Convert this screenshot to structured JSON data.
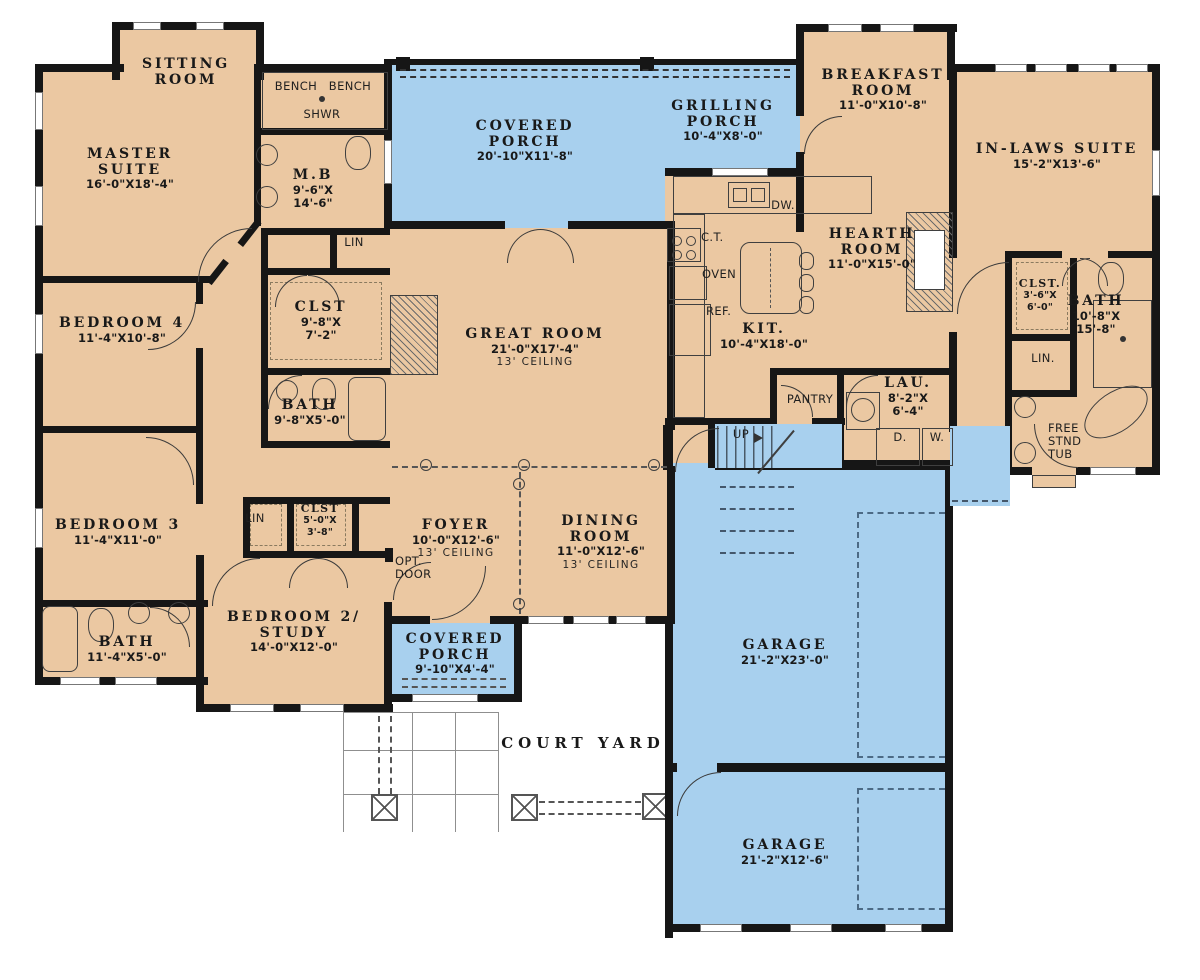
{
  "colors": {
    "floor": "#ebc8a2",
    "porch": "#a8d0ee",
    "wall": "#161616",
    "background": "#ffffff"
  },
  "labels": [
    {
      "id": "sitting-room",
      "x": 186,
      "y": 57,
      "lines": [
        "SITTING",
        "ROOM"
      ]
    },
    {
      "id": "master-suite",
      "x": 130,
      "y": 147,
      "lines": [
        "MASTER",
        "SUITE"
      ],
      "dims": [
        "16'-0\"X18'-4\""
      ]
    },
    {
      "id": "bench-1",
      "x": 296,
      "y": 80,
      "lines": [
        "BENCH"
      ],
      "cls": "sm"
    },
    {
      "id": "bench-2",
      "x": 350,
      "y": 80,
      "lines": [
        "BENCH"
      ],
      "cls": "sm"
    },
    {
      "id": "shwr",
      "x": 322,
      "y": 108,
      "lines": [
        "SHWR"
      ],
      "cls": "sm"
    },
    {
      "id": "master-bath",
      "x": 313,
      "y": 168,
      "lines": [
        "M.B"
      ],
      "dims": [
        "9'-6\"X",
        "14'-6\""
      ]
    },
    {
      "id": "lin-master",
      "x": 354,
      "y": 236,
      "lines": [
        "LIN"
      ],
      "cls": "sm"
    },
    {
      "id": "clst-master",
      "x": 321,
      "y": 300,
      "lines": [
        "CLST"
      ],
      "dims": [
        "9'-8\"X",
        "7'-2\""
      ]
    },
    {
      "id": "bedroom-4",
      "x": 122,
      "y": 316,
      "lines": [
        "BEDROOM 4"
      ],
      "dims": [
        "11'-4\"X10'-8\""
      ]
    },
    {
      "id": "bath-2",
      "x": 310,
      "y": 398,
      "lines": [
        "BATH"
      ],
      "dims": [
        "9'-8\"X5'-0\""
      ]
    },
    {
      "id": "bedroom-3",
      "x": 118,
      "y": 518,
      "lines": [
        "BEDROOM 3"
      ],
      "dims": [
        "11'-4\"X11'-0\""
      ]
    },
    {
      "id": "lin-hall",
      "x": 255,
      "y": 512,
      "lines": [
        "LIN"
      ],
      "cls": "sm"
    },
    {
      "id": "clst-hall",
      "x": 320,
      "y": 503,
      "lines": [
        "CLST"
      ],
      "dims": [
        "5'-0\"X",
        "3'-8\""
      ],
      "cls": "smd"
    },
    {
      "id": "opt-door",
      "x": 395,
      "y": 555,
      "lines": [
        "OPT.",
        "DOOR"
      ],
      "cls": "sm",
      "align": "left"
    },
    {
      "id": "bedroom-2",
      "x": 294,
      "y": 610,
      "lines": [
        "BEDROOM 2/",
        "STUDY"
      ],
      "dims": [
        "14'-0\"X12'-0\""
      ]
    },
    {
      "id": "bath-3",
      "x": 127,
      "y": 635,
      "lines": [
        "BATH"
      ],
      "dims": [
        "11'-4\"X5'-0\""
      ]
    },
    {
      "id": "covered-porch",
      "x": 525,
      "y": 119,
      "lines": [
        "COVERED",
        "PORCH"
      ],
      "dims": [
        "20'-10\"X11'-8\""
      ]
    },
    {
      "id": "grilling-porch",
      "x": 723,
      "y": 99,
      "lines": [
        "GRILLING",
        "PORCH"
      ],
      "dims": [
        "10'-4\"X8'-0\""
      ]
    },
    {
      "id": "breakfast-room",
      "x": 883,
      "y": 68,
      "lines": [
        "BREAKFAST",
        "ROOM"
      ],
      "dims": [
        "11'-0\"X10'-8\""
      ]
    },
    {
      "id": "in-laws-suite",
      "x": 1057,
      "y": 142,
      "lines": [
        "IN-LAWS SUITE"
      ],
      "dims": [
        "15'-2\"X13'-6\""
      ]
    },
    {
      "id": "great-room",
      "x": 535,
      "y": 327,
      "lines": [
        "GREAT ROOM"
      ],
      "dims": [
        "21'-0\"X17'-4\""
      ],
      "note": "13' CEILING"
    },
    {
      "id": "hearth-room",
      "x": 872,
      "y": 227,
      "lines": [
        "HEARTH",
        "ROOM"
      ],
      "dims": [
        "11'-0\"X15'-0\""
      ]
    },
    {
      "id": "kitchen",
      "x": 764,
      "y": 322,
      "lines": [
        "KIT."
      ],
      "dims": [
        "10'-4\"X18'-0\""
      ]
    },
    {
      "id": "counter-top",
      "x": 701,
      "y": 231,
      "lines": [
        "C.T."
      ],
      "cls": "sm",
      "align": "left"
    },
    {
      "id": "oven",
      "x": 702,
      "y": 268,
      "lines": [
        "OVEN"
      ],
      "cls": "sm",
      "align": "left"
    },
    {
      "id": "refrigerator",
      "x": 706,
      "y": 305,
      "lines": [
        "REF."
      ],
      "cls": "sm",
      "align": "left"
    },
    {
      "id": "dishwasher",
      "x": 783,
      "y": 199,
      "lines": [
        "DW."
      ],
      "cls": "sm"
    },
    {
      "id": "pantry",
      "x": 810,
      "y": 393,
      "lines": [
        "PANTRY"
      ],
      "cls": "sm"
    },
    {
      "id": "laundry",
      "x": 908,
      "y": 376,
      "lines": [
        "LAU."
      ],
      "dims": [
        "8'-2\"X",
        "6'-4\""
      ]
    },
    {
      "id": "dryer",
      "x": 900,
      "y": 431,
      "lines": [
        "D."
      ],
      "cls": "sm"
    },
    {
      "id": "washer",
      "x": 937,
      "y": 431,
      "lines": [
        "W."
      ],
      "cls": "sm"
    },
    {
      "id": "stairs-up",
      "x": 741,
      "y": 428,
      "lines": [
        "UP"
      ],
      "cls": "sm"
    },
    {
      "id": "clst-inlaws",
      "x": 1040,
      "y": 278,
      "lines": [
        "CLST."
      ],
      "dims": [
        "3'-6\"X",
        "6'-0\""
      ],
      "cls": "smd"
    },
    {
      "id": "bath-inlaws",
      "x": 1096,
      "y": 294,
      "lines": [
        "BATH"
      ],
      "dims": [
        "10'-8\"X",
        "15'-8\""
      ]
    },
    {
      "id": "lin-inlaws",
      "x": 1043,
      "y": 352,
      "lines": [
        "LIN."
      ],
      "cls": "sm"
    },
    {
      "id": "free-stnd-tub",
      "x": 1048,
      "y": 422,
      "lines": [
        "FREE",
        "STND",
        "TUB"
      ],
      "cls": "sm",
      "align": "left"
    },
    {
      "id": "foyer",
      "x": 456,
      "y": 518,
      "lines": [
        "FOYER"
      ],
      "dims": [
        "10'-0\"X12'-6\""
      ],
      "note": "13' CEILING"
    },
    {
      "id": "dining-room",
      "x": 601,
      "y": 514,
      "lines": [
        "DINING",
        "ROOM"
      ],
      "dims": [
        "11'-0\"X12'-6\""
      ],
      "note": "13' CEILING"
    },
    {
      "id": "covered-porch-2",
      "x": 455,
      "y": 632,
      "lines": [
        "COVERED",
        "PORCH"
      ],
      "dims": [
        "9'-10\"X4'-4\""
      ]
    },
    {
      "id": "court-yard",
      "x": 583,
      "y": 735,
      "lines": [
        "COURT YARD"
      ],
      "cls": "court"
    },
    {
      "id": "garage-1",
      "x": 785,
      "y": 638,
      "lines": [
        "GARAGE"
      ],
      "dims": [
        "21'-2\"X23'-0\""
      ]
    },
    {
      "id": "garage-2",
      "x": 785,
      "y": 838,
      "lines": [
        "GARAGE"
      ],
      "dims": [
        "21'-2\"X12'-6\""
      ]
    }
  ]
}
